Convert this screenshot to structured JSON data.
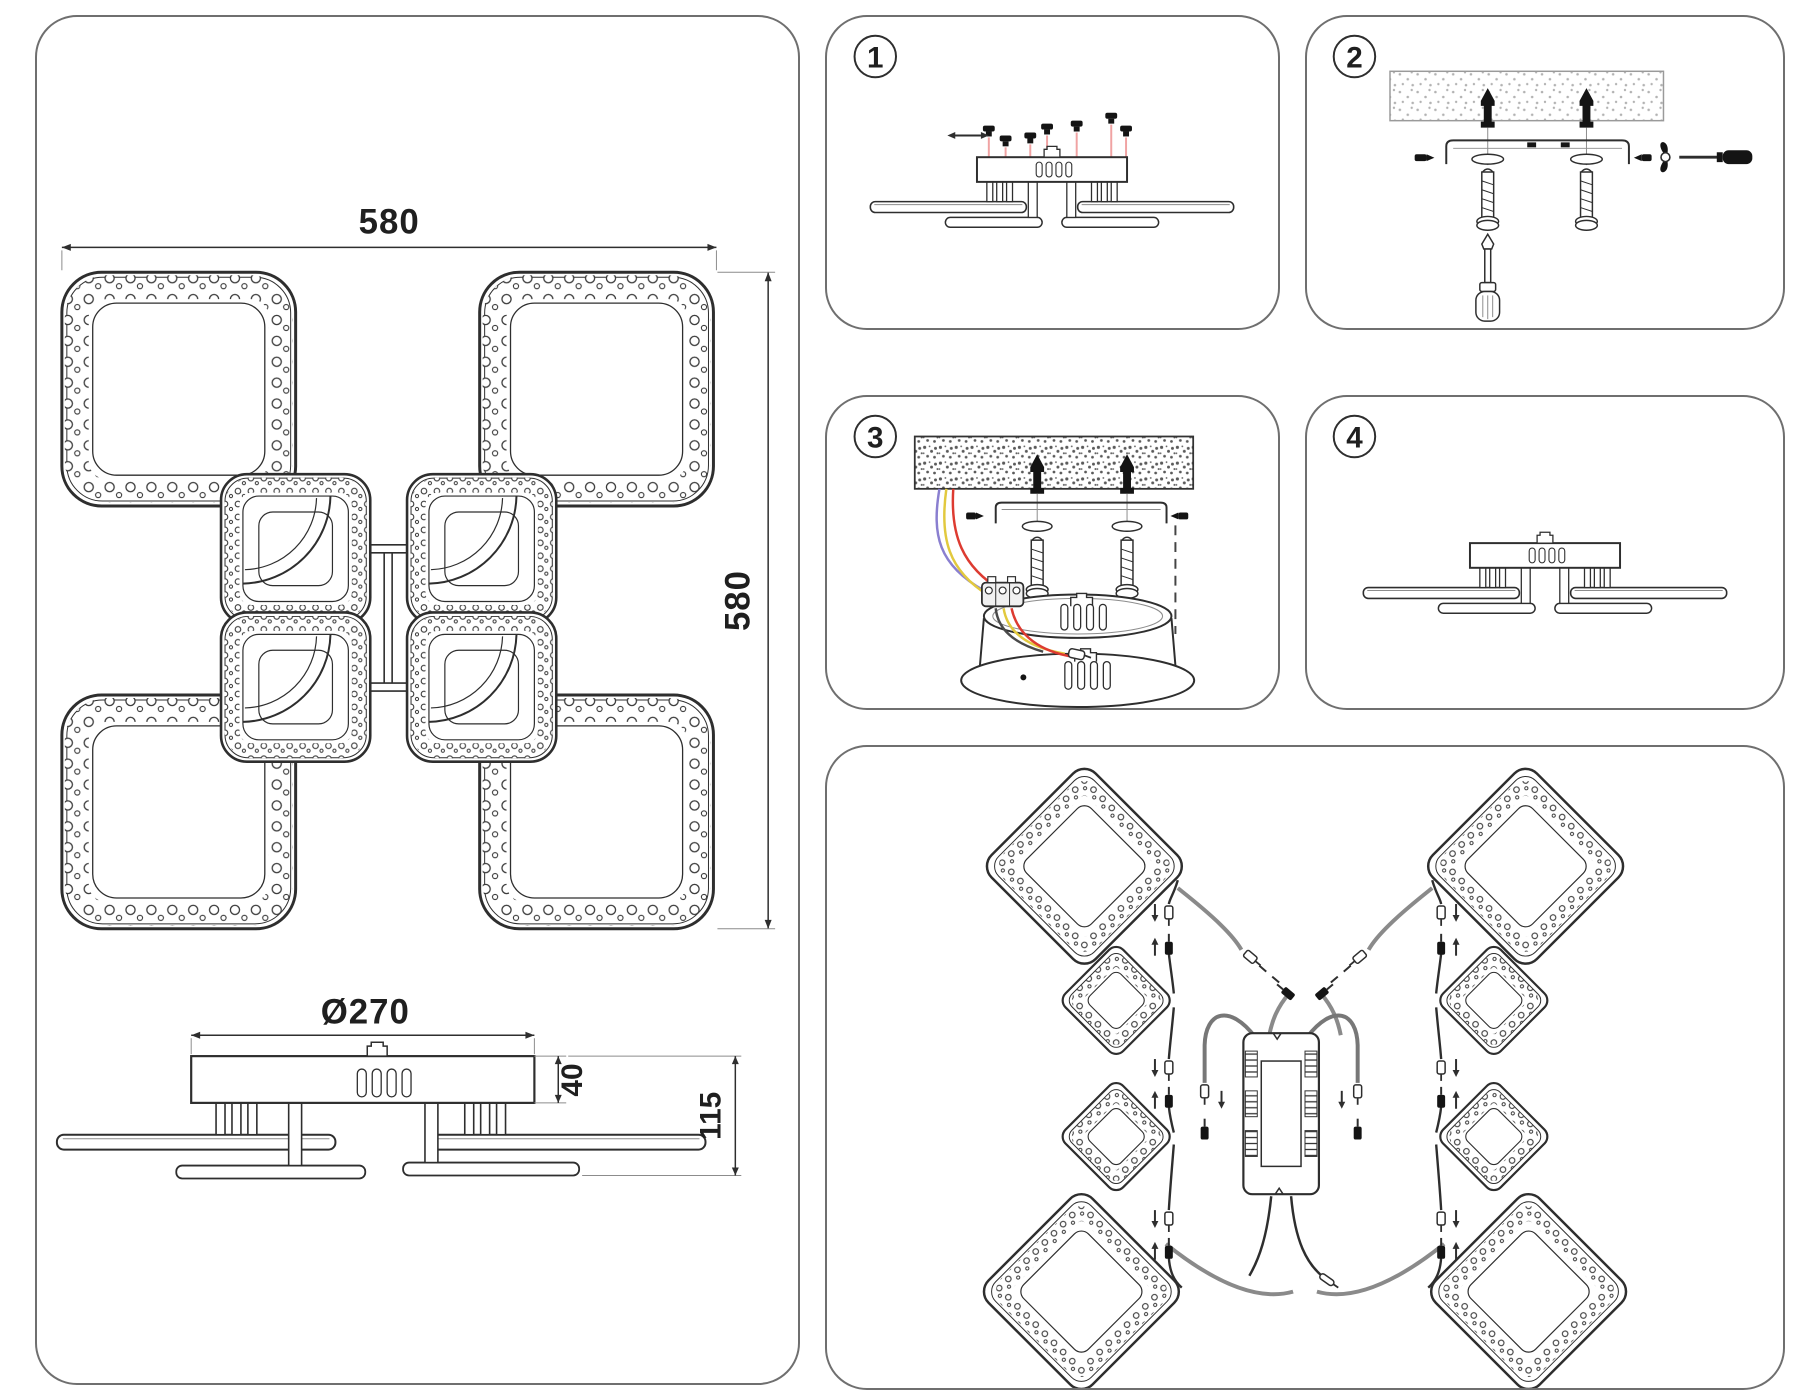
{
  "left_panel": {
    "top_view": {
      "width_label": "580",
      "height_label": "580"
    },
    "side_view": {
      "diameter_label": "Ø270",
      "canopy_height_label": "40",
      "total_height_label": "115"
    }
  },
  "steps": [
    {
      "number": "1"
    },
    {
      "number": "2"
    },
    {
      "number": "3"
    },
    {
      "number": "4"
    }
  ],
  "colors": {
    "line": "#2e2e2e",
    "panel_border": "#6f6f6f",
    "screw_guide_pink": "#f0a3a3",
    "wire_blue": "#8a7fd0",
    "wire_yellow": "#e2c93e",
    "wire_red": "#dd3b31",
    "wire_gray": "#8a8a8a"
  }
}
